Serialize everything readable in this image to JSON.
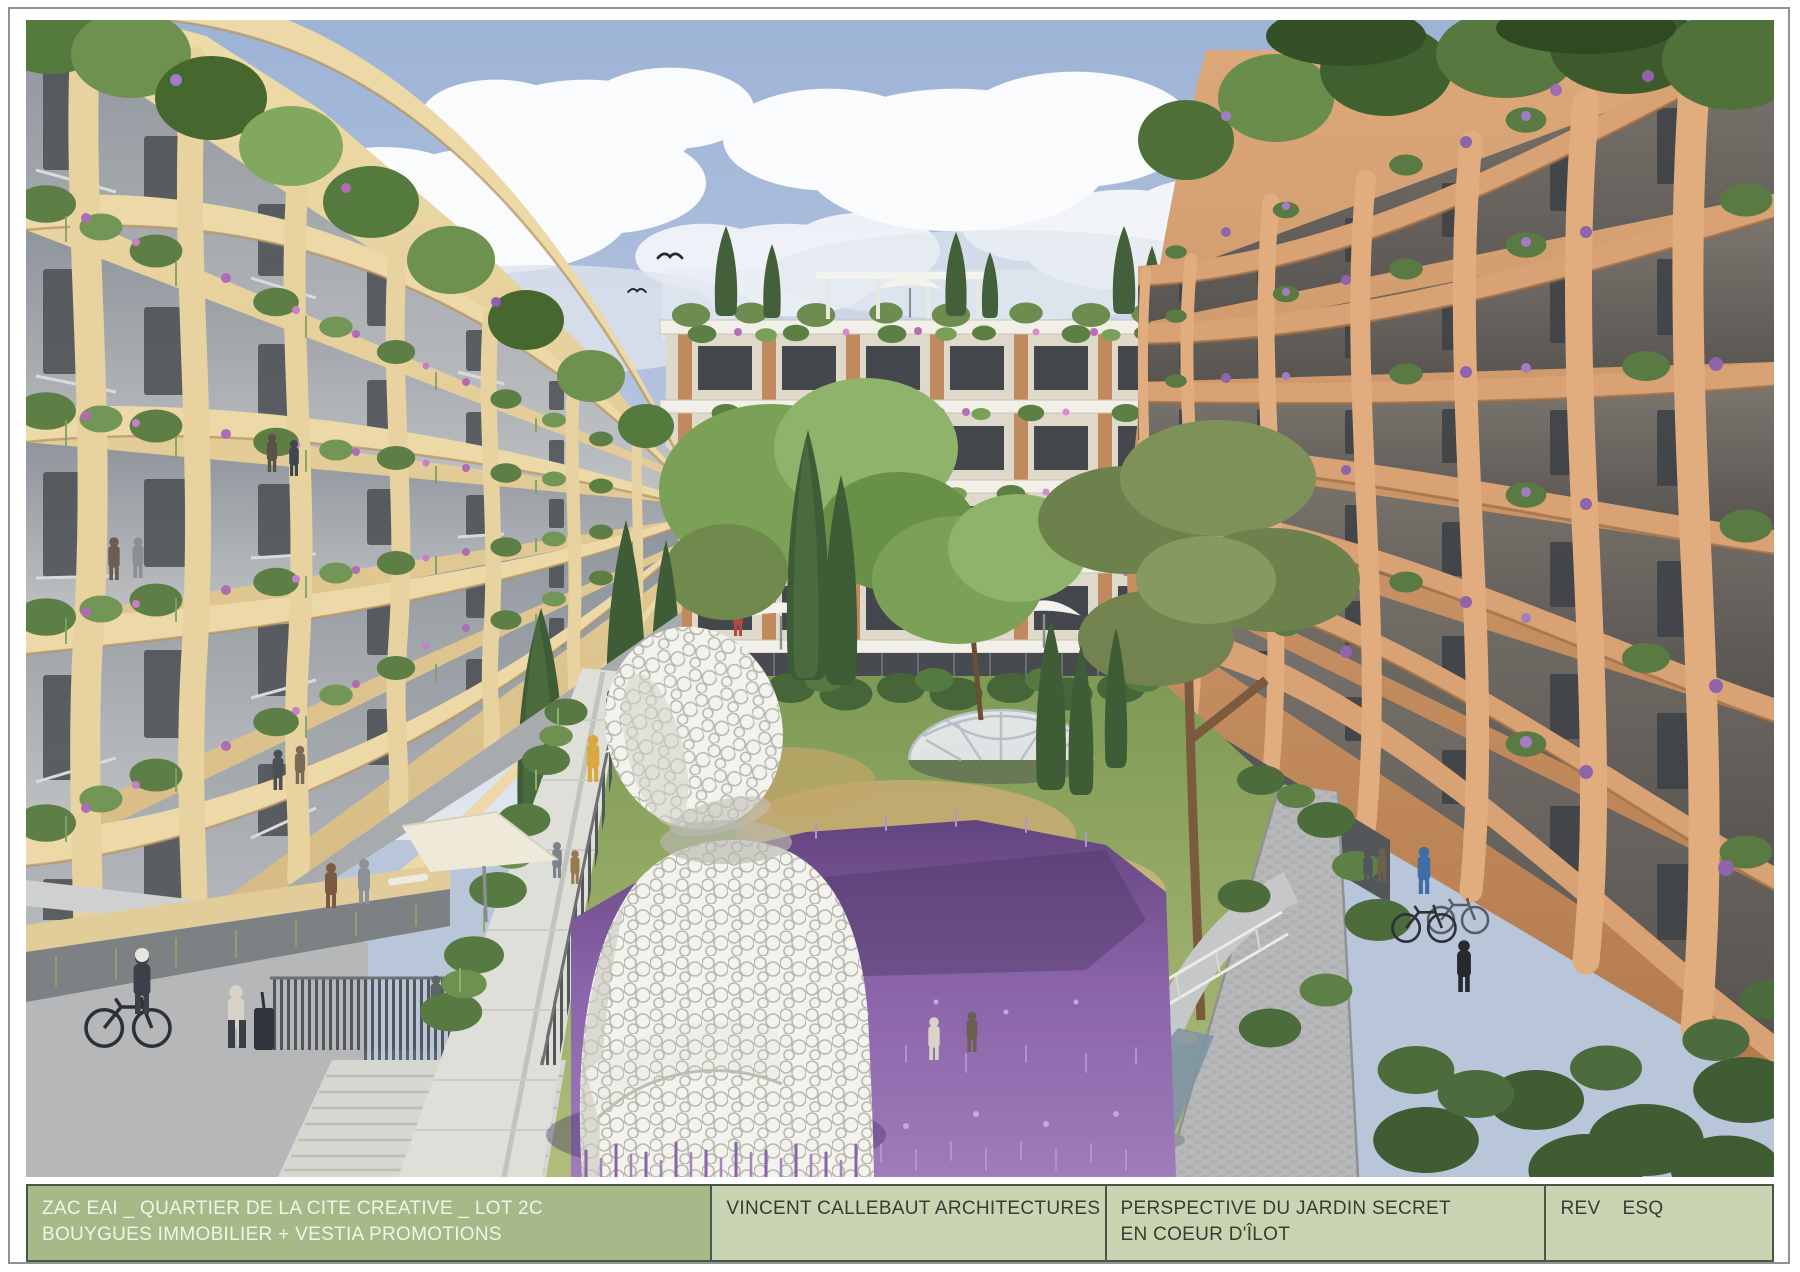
{
  "title_block": {
    "project": {
      "line1": "ZAC EAI _ QUARTIER DE LA CITE CREATIVE _ LOT 2C",
      "line2": "BOUYGUES IMMOBILIER + VESTIA PROMOTIONS"
    },
    "architect": "VINCENT CALLEBAUT ARCHITECTURES",
    "drawing_title": {
      "line1": "PERSPECTIVE DU JARDIN SECRET",
      "line2": "EN COEUR D'ÎLOT"
    },
    "revision": {
      "label": "REV",
      "code": "ESQ"
    }
  },
  "scene": {
    "aria_label": "Architectural rendering of a secret garden courtyard between plant-covered apartment buildings, with a white lattice sculpture, lavender field, walkways and residents",
    "birds_count": 3,
    "palette": {
      "sky": "#a3b8d8",
      "cloud": "#fafbfd",
      "left_building_beige": "#e8d4a2",
      "right_building_terracotta": "#d29a6f",
      "center_building_cream": "#f1efe8",
      "foliage_dark": "#3e5c35",
      "foliage_light": "#7aa156",
      "lavender": "#8a63a8",
      "sculpture_white": "#f3f3ee",
      "path_gray": "#dedfd8",
      "titleblock_green_dark": "#a5b989",
      "titleblock_green_light": "#c9d5b2",
      "frame_border": "#8e9492"
    }
  }
}
